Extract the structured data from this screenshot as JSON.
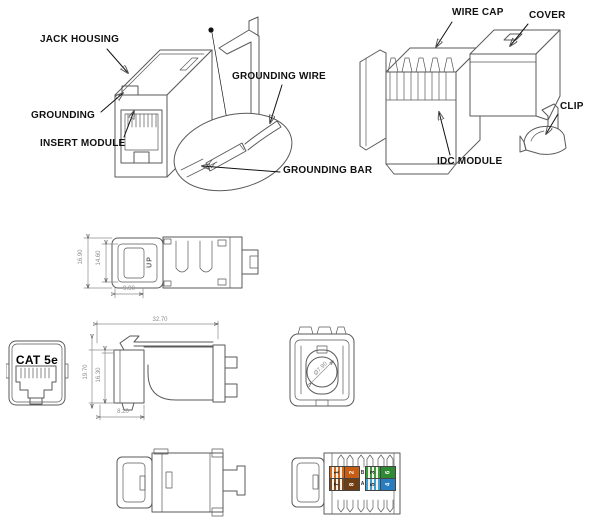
{
  "page": {
    "background": "#ffffff",
    "line_color": "#5a5a5a",
    "label_color": "#111111",
    "dim_color": "#8c8c8c"
  },
  "exploded_view_left": {
    "callouts": {
      "jack_housing": "JACK HOUSING",
      "grounding": "GROUNDING",
      "insert_module": "INSERT MODULE",
      "grounding_wire": "GROUNDING WIRE",
      "grounding_bar": "GROUNDING BAR"
    }
  },
  "exploded_view_right": {
    "callouts": {
      "wire_cap": "WIRE CAP",
      "cover": "COVER",
      "clip": "CLIP",
      "idc_module": "IDC MODULE"
    }
  },
  "dimension_views": {
    "top_view": {
      "height_outer": "16.90",
      "height_inner": "14.60",
      "width_front": "9.90",
      "marking": "UP"
    },
    "front_view": {
      "product_marking": "CAT 5e"
    },
    "side_view": {
      "length": "32.70",
      "height_outer": "19.70",
      "height_inner": "16.30",
      "depth_front": "8.20"
    },
    "rear_view": {
      "bore_diameter": "Ø7.90"
    }
  },
  "wiring_label": {
    "standard_markers": [
      "B",
      "A"
    ],
    "blocks": [
      {
        "rows": [
          [
            {
              "pin": "1",
              "color": "#d2691e",
              "striped": true
            },
            {
              "pin": "2",
              "color": "#c65d12",
              "striped": false
            }
          ],
          [
            {
              "pin": "7",
              "color": "#7b4a21",
              "striped": true
            },
            {
              "pin": "8",
              "color": "#6e3d14",
              "striped": false
            }
          ]
        ]
      },
      {
        "rows": [
          [
            {
              "pin": "3",
              "color": "#3a9a3e",
              "striped": true
            },
            {
              "pin": "6",
              "color": "#2e8a33",
              "striped": false
            }
          ],
          [
            {
              "pin": "5",
              "color": "#3e9ed6",
              "striped": true
            },
            {
              "pin": "4",
              "color": "#2a7cc0",
              "striped": false
            }
          ]
        ]
      }
    ]
  }
}
